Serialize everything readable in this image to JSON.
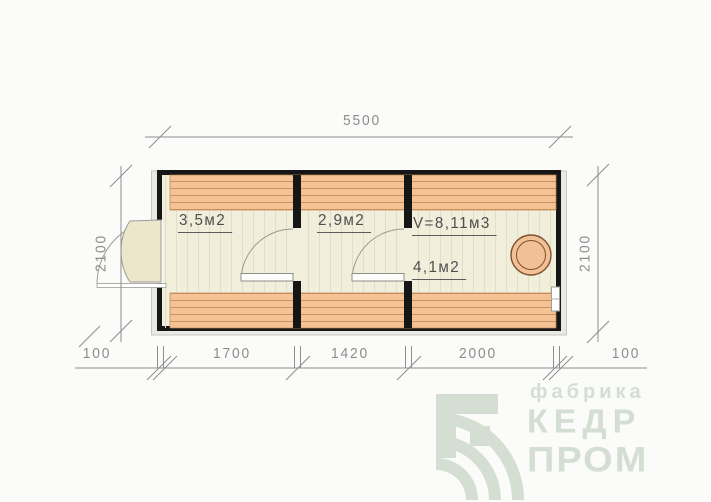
{
  "drawing": {
    "overall_width_label": "5500",
    "left_height_label": "2100",
    "right_height_label": "2100",
    "bottom_labels": [
      "100",
      "1700",
      "1420",
      "2000",
      "100"
    ],
    "rooms": [
      {
        "area": "3,5м2"
      },
      {
        "area": "2,9м2"
      },
      {
        "volume": "V=8,11м3",
        "area": "4,1м2"
      }
    ],
    "colors": {
      "wall": "#161616",
      "plank_band": "#f5c294",
      "plank_line": "#ca9162",
      "floor": "#f1eedb",
      "floor_line": "#e2dfc7",
      "dimension_gray": "#8d8d8d",
      "room_text": "#4f4f4f",
      "stove_fill": "#f2c095",
      "stove_stroke": "#7e5130",
      "logo_sage": "#d5ded3"
    }
  },
  "logo": {
    "tagline": "фабрика",
    "word1": "КЕДР",
    "word2": "ПРОМ"
  }
}
